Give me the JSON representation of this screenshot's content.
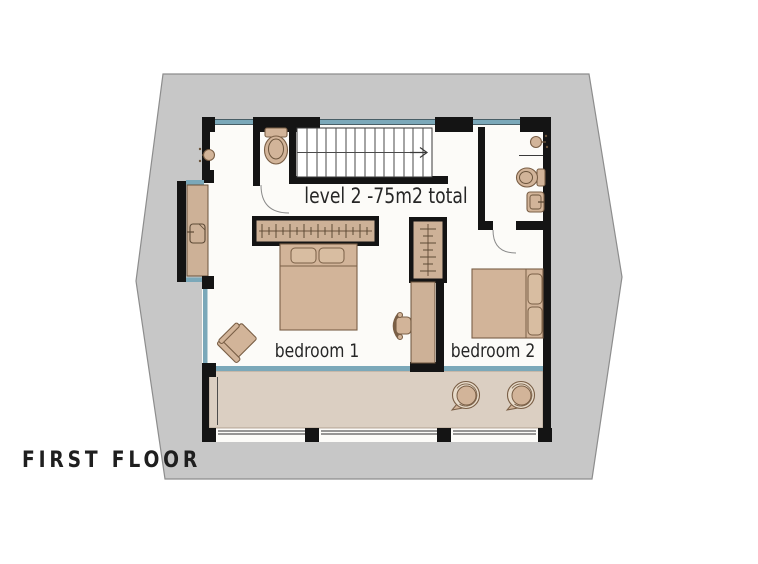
{
  "title": {
    "label": "FIRST FLOOR"
  },
  "plan": {
    "level_label": "level 2 -75m2 total",
    "rooms": [
      {
        "label": "bedroom 1"
      },
      {
        "label": "bedroom 2"
      }
    ],
    "fixtures": [
      "stairs-with-direction-arrow",
      "wc-toilet",
      "shower-head-left",
      "bay-cabinet-with-sink",
      "bathroom-shower-head",
      "bathroom-toilet",
      "bathroom-washbasin",
      "wardrobe-bedroom-1",
      "double-bed-bedroom-1",
      "armchair",
      "desk-chair",
      "desk",
      "wardrobe-bedroom-2",
      "double-bed-bedroom-2",
      "terrace",
      "terrace-chair-left",
      "terrace-chair-right",
      "door-arcs"
    ],
    "colors": {
      "plot_gray": "#c7c7c7",
      "plot_edge": "#8d8d8d",
      "wall_black": "#141414",
      "window_glass": "#7ba8b9",
      "floor_white": "#fcfbf8",
      "terrace_floor": "#dbcfc2",
      "furniture_tan": "#d2b499",
      "furniture_outline": "#7a5f46",
      "text": "#262626"
    }
  }
}
